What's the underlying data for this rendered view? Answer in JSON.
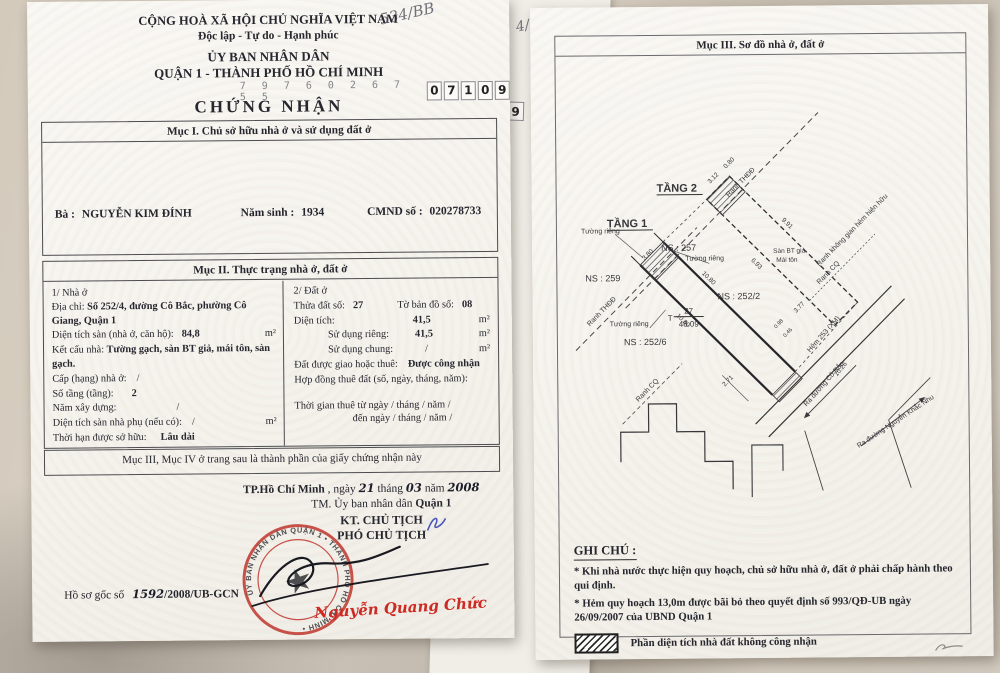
{
  "left": {
    "corner_note": "534/BB",
    "national_title": "CỘNG HOÀ XÃ HỘI CHỦ NGHĨA VIỆT NAM",
    "motto": "Độc lập - Tự do - Hạnh phúc",
    "issuer1": "ỦY BAN NHÂN DÂN",
    "issuer2": "QUẬN 1 - THÀNH PHỐ HỒ CHÍ MINH",
    "serial_faint": "7 9 7 6 0 2 6 7 5 5",
    "serial_boxed": [
      "0",
      "7",
      "1",
      "0",
      "9"
    ],
    "title": "CHỨNG NHẬN",
    "muc1": {
      "heading": "Mục I. Chủ sở hữu nhà ở và sử dụng đất ở",
      "owner_label": "Bà :",
      "owner_name": "NGUYỄN KIM ĐÍNH",
      "birth_label": "Năm sinh :",
      "birth_year": "1934",
      "id_label": "CMND số :",
      "id_number": "020278733"
    },
    "muc2": {
      "heading": "Mục II. Thực trạng nhà ở, đất ở",
      "house": {
        "title": "1/ Nhà ở",
        "address_label": "Địa chỉ:",
        "address": "Số 252/4, đường Cô Bắc, phường Cô Giang, Quận 1",
        "area_label": "Diện tích sàn (nhà ở, căn hộ):",
        "area": "84,8",
        "area_unit": "m²",
        "structure_label": "Kết cấu nhà:",
        "structure": "Tường gạch, sàn BT giả, mái tôn, sàn gạch.",
        "grade_label": "Cấp (hạng) nhà ở:",
        "grade": "/",
        "floors_label": "Số tầng (tầng):",
        "floors": "2",
        "year_label": "Năm xây dựng:",
        "year": "/",
        "aux_label": "Diện tích sàn nhà phụ (nếu có):",
        "aux": "/",
        "aux_unit": "m²",
        "tenure_label": "Thời hạn được sở hữu:",
        "tenure": "Lâu dài"
      },
      "land": {
        "title": "2/ Đất ở",
        "plot_label": "Thửa đất số:",
        "plot": "27",
        "map_label": "Tờ bản đồ số:",
        "map": "08",
        "area_label": "Diện tích:",
        "area": "41,5",
        "area_unit": "m²",
        "private_label": "Sử dụng riêng:",
        "private": "41,5",
        "private_unit": "m²",
        "shared_label": "Sử dụng chung:",
        "shared": "/",
        "shared_unit": "m²",
        "granted_label": "Đất được giao hoặc thuê:",
        "granted": "Được công nhận",
        "contract_label": "Hợp đồng thuê đất (số, ngày, tháng, năm):",
        "lease_from": "Thời gian thuê từ ngày  /      tháng  /        năm  /",
        "lease_to": "đến ngày  /      tháng  /       năm  /"
      }
    },
    "muc34_note": "Mục III, Mục IV ở trang sau là thành phần của giấy chứng nhận này",
    "sign": {
      "place": "TP.Hồ Chí Minh",
      "pre": ", ngày",
      "day": "21",
      "m_label": "tháng",
      "month": "03",
      "y_label": "năm",
      "year": "2008",
      "tm": "TM. Ủy ban nhân dân",
      "tm_unit": "Quận 1",
      "kt": "KT. CHỦ TỊCH",
      "deputy": "PHÓ CHỦ TỊCH",
      "signer": "Nguyễn Quang Chức",
      "stamp_text": "ỦY BAN NHÂN DÂN QUẬN 1 • THÀNH PHỐ HỒ CHÍ MINH •"
    },
    "dossier": {
      "label": "Hồ sơ gốc số",
      "number": "1592",
      "suffix": "/2008/UB-GCN"
    }
  },
  "middle": {
    "digit": "9",
    "note": "4/BB"
  },
  "right": {
    "heading": "Mục III. Sơ đồ nhà ở, đất ở",
    "diagram": {
      "tang1": "TẦNG 1",
      "tang2": "TẦNG 2",
      "ns257": "NS : 257",
      "ns259": "NS : 259",
      "ns252_2": "NS : 252/2",
      "ns252_6": "NS : 252/6",
      "wall": "Tường riêng",
      "ranh_thdd": "Ranh THĐĐ",
      "ranh_cq": "Ranh CQ",
      "ranh_space": "Ranh không gian hẻm hiện hữu",
      "floor_note1": "Sàn BT giả",
      "floor_note2": "Mái tôn",
      "alley": "Hẻm 253 (XM)",
      "to_cobac": "Ra đường Cô Bắc",
      "to_nkn": "Ra đường Nguyễn Khắc Nhu",
      "parcel_t": "T",
      "parcel_no": "27",
      "parcel_area": "48.09",
      "dims": {
        "a": "3.80",
        "b": "3.12",
        "c": "0.80",
        "d": "9.91",
        "e": "6.93",
        "f": "10.80",
        "g": "10.80",
        "h": "3.77",
        "i": "2.71",
        "j": "10.26",
        "k": "0.98",
        "l": "0.46"
      }
    },
    "notes": {
      "heading": "GHI CHÚ :",
      "n1": "* Khi nhà nước thực hiện quy hoạch, chủ sở hữu nhà ở, đất ở phải chấp hành theo qui định.",
      "n2": "* Hẻm quy hoạch 13,0m được bãi bỏ theo quyết định số 993/QĐ-UB ngày 26/09/2007 của UBND Quận 1",
      "legend1": "Phần diện tích nhà đất không công nhận",
      "legend2": "Phần diện tích nhà có chủ quyền phạm quy hoạch được công nhận"
    }
  }
}
